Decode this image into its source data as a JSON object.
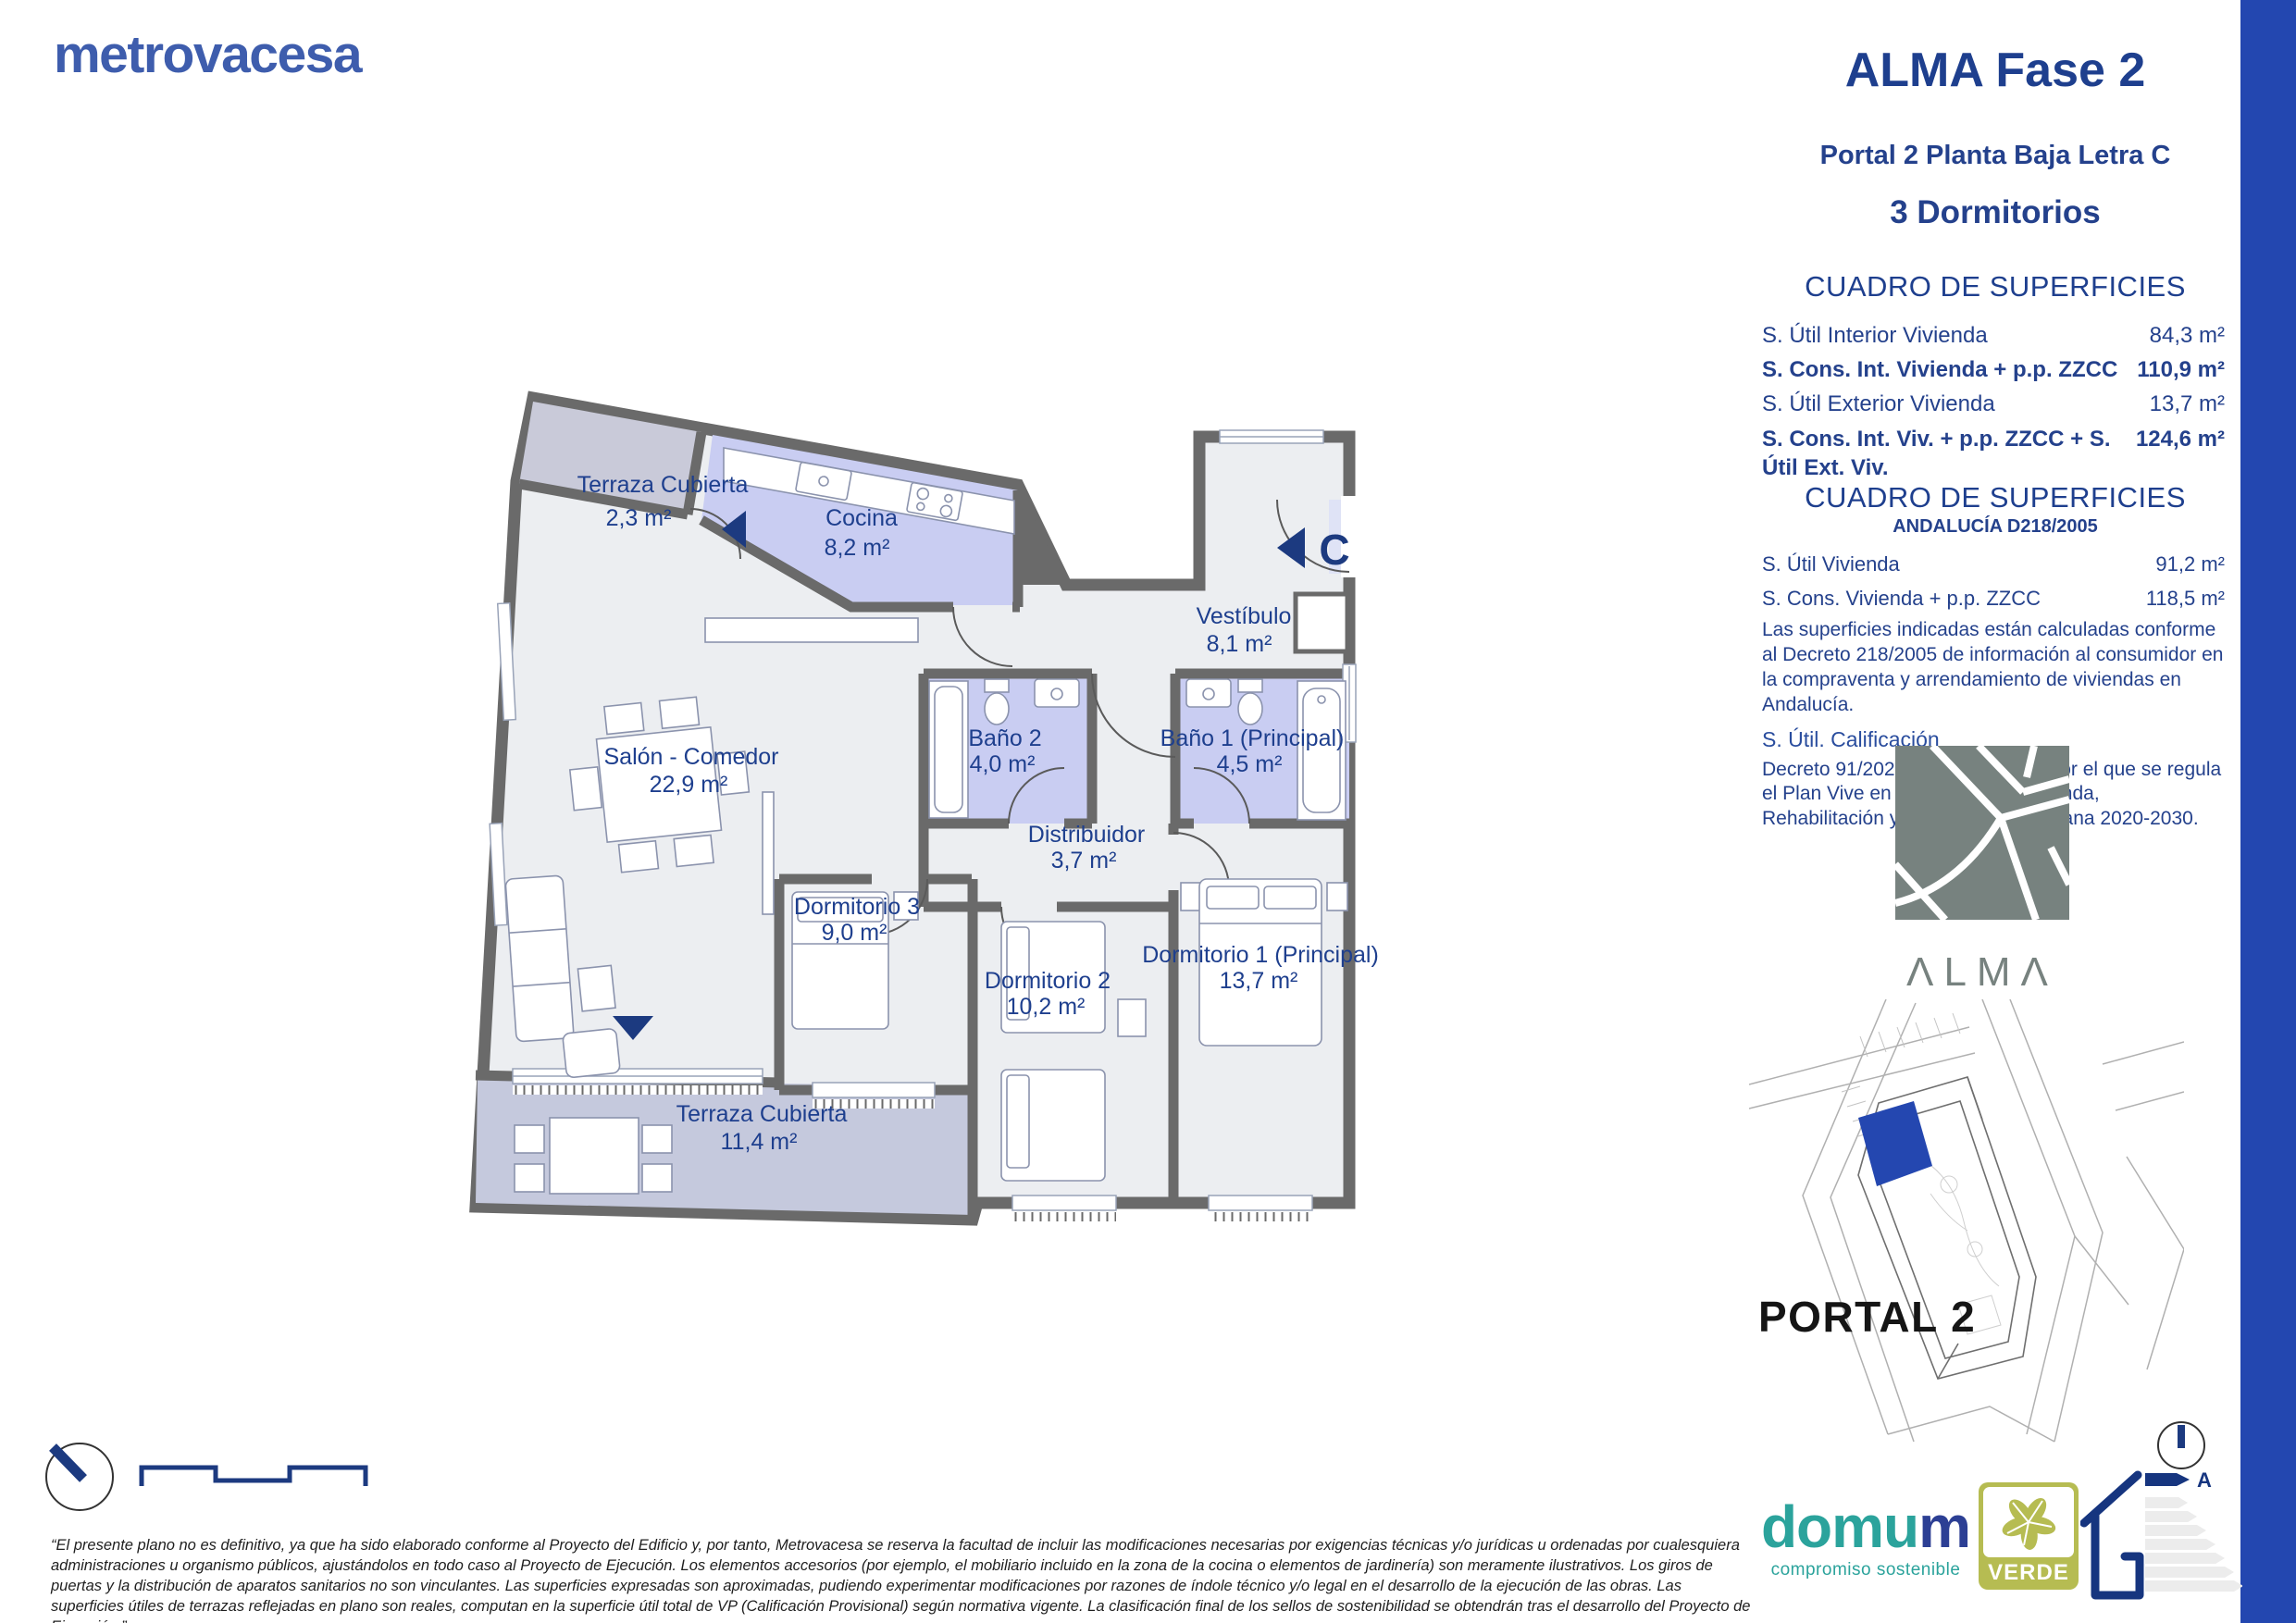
{
  "brand": {
    "logo_text": "metrovacesa"
  },
  "header": {
    "title": "ALMA Fase 2",
    "subtitle": "Portal 2 Planta Baja Letra C",
    "type": "3 Dormitorios"
  },
  "surfaces": {
    "title": "CUADRO DE SUPERFICIES",
    "rows": [
      {
        "label": "S. Útil Interior Vivienda",
        "value": "84,3 m²"
      },
      {
        "label": "S. Cons. Int. Vivienda + p.p. ZZCC",
        "value": "110,9 m²"
      },
      {
        "label": "S. Útil Exterior Vivienda",
        "value": "13,7 m²"
      },
      {
        "label": "S. Cons. Int. Viv. + p.p. ZZCC + S. Útil Ext. Viv.",
        "value": "124,6 m²"
      }
    ]
  },
  "surfaces_andalucia": {
    "title": "CUADRO DE SUPERFICIES",
    "subtitle": "ANDALUCÍA D218/2005",
    "rows": [
      {
        "label": "S. Útil Vivienda",
        "value": "91,2 m²"
      },
      {
        "label": "S. Cons. Vivienda + p.p. ZZCC",
        "value": "118,5 m²"
      }
    ],
    "note_decreto": "Las superficies indicadas están calculadas conforme al Decreto 218/2005 de información al consumidor en la compraventa y arrendamiento de viviendas en Andalucía.",
    "calificacion_label": "S. Útil. Calificación",
    "note_plan_vive": "Decreto 91/2020, de 30 de junio, por el que se regula el Plan Vive en Andalucía, de Vivienda, Rehabilitación y Regeneración Urbana 2020-2030."
  },
  "alma": {
    "wordmark": "ΛLMΛ"
  },
  "site_plan": {
    "portal_label": "PORTAL 2"
  },
  "floor_plan": {
    "entrance_letter": "C",
    "rooms": [
      {
        "name": "Terraza Cubierta",
        "area": "2,3 m²"
      },
      {
        "name": "Cocina",
        "area": "8,2 m²"
      },
      {
        "name": "Vestíbulo",
        "area": "8,1 m²"
      },
      {
        "name": "Salón - Comedor",
        "area": "22,9 m²"
      },
      {
        "name": "Baño 2",
        "area": "4,0 m²"
      },
      {
        "name": "Baño 1 (Principal)",
        "area": "4,5 m²"
      },
      {
        "name": "Distribuidor",
        "area": "3,7 m²"
      },
      {
        "name": "Dormitorio 3",
        "area": "9,0 m²"
      },
      {
        "name": "Dormitorio 2",
        "area": "10,2 m²"
      },
      {
        "name": "Dormitorio 1 (Principal)",
        "area": "13,7 m²"
      },
      {
        "name": "Terraza Cubierta",
        "area": "11,4 m²"
      }
    ]
  },
  "footer": {
    "disclaimer": "“El presente plano no es definitivo, ya que ha sido elaborado conforme al Proyecto del Edificio y, por tanto, Metrovacesa se reserva la facultad de incluir las modificaciones necesarias por exigencias técnicas y/o jurídicas u ordenadas por cualesquiera administraciones u organismo públicos, ajustándolos en todo caso al Proyecto de Ejecución. Los elementos accesorios (por ejemplo, el mobiliario incluido en la zona de la cocina o elementos de jardinería) son meramente ilustrativos. Los giros de puertas y la distribución de aparatos sanitarios no son vinculantes. Las superficies expresadas son aproximadas, pudiendo experimentar modificaciones por razones de índole técnico y/o legal en el desarrollo de la ejecución de las obras. Las superficies útiles de terrazas reflejadas en plano son reales, computan en la superficie útil total de VP (Calificación Provisional) según normativa vigente. La clasificación final de los sellos de sostenibilidad se obtendrán tras el desarrollo del Proyecto de Ejecución.”",
    "domum": {
      "name_start": "domu",
      "name_end": "m",
      "tagline": "compromiso sostenible"
    },
    "verde": {
      "label": "VERDE"
    },
    "energy": {
      "rating": "A"
    }
  },
  "colors": {
    "accent_blue": "#2347b0",
    "navy_text": "#24418c",
    "brand_blue": "#3e5dad",
    "wall_gray": "#6a6a6a",
    "room_lavender": "#c9cdf2",
    "terrace_blue_gray": "#c5c9dd",
    "alma_gray": "#77827f",
    "domum_teal": "#2ba39c",
    "verde_olive": "#b6bc52",
    "portal_black": "#151515"
  }
}
